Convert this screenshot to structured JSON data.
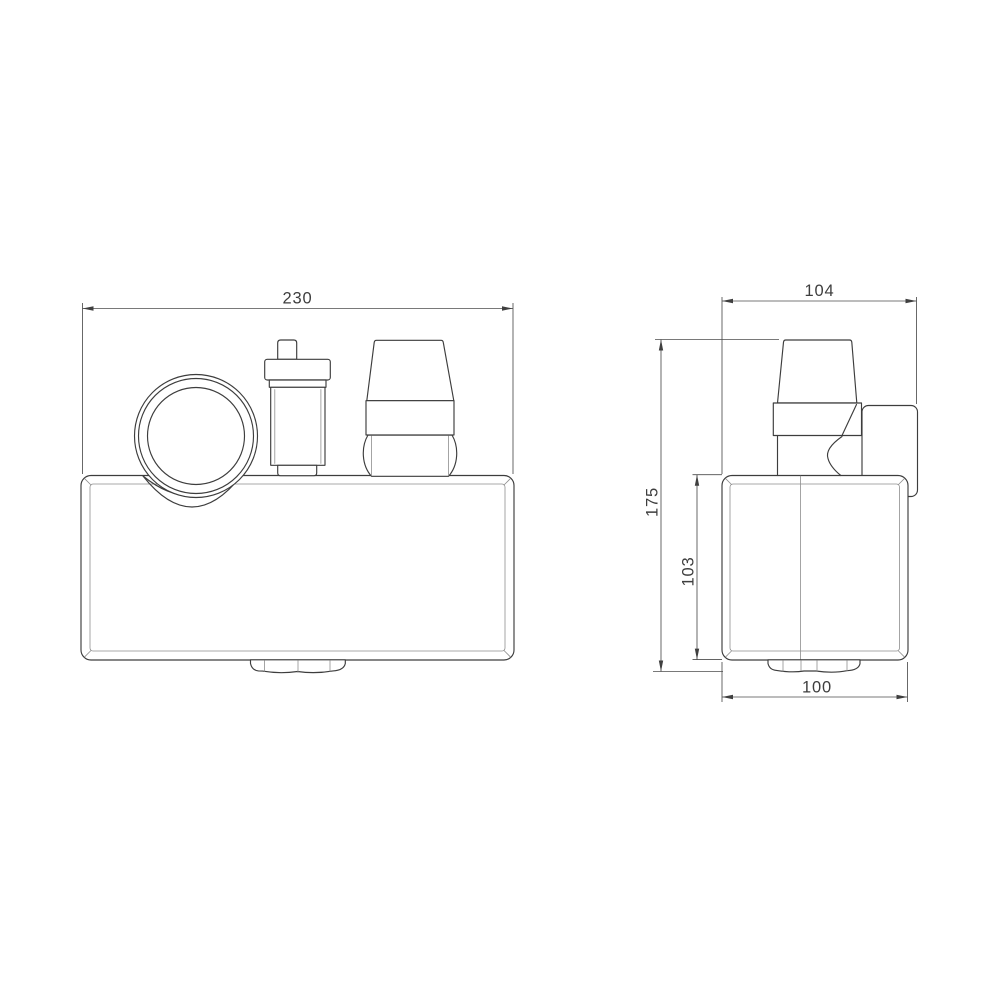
{
  "dimensions": {
    "front_width": "230",
    "side_depth_overall": "104",
    "side_height_overall": "175",
    "side_body_height": "103",
    "side_body_depth": "100"
  },
  "style": {
    "background": "#ffffff",
    "object_line_color": "#3d3d3d",
    "thin_line_color": "#8e8e8e",
    "dimension_line_color": "#4d4d4d",
    "label_color": "#3e3e3e"
  }
}
